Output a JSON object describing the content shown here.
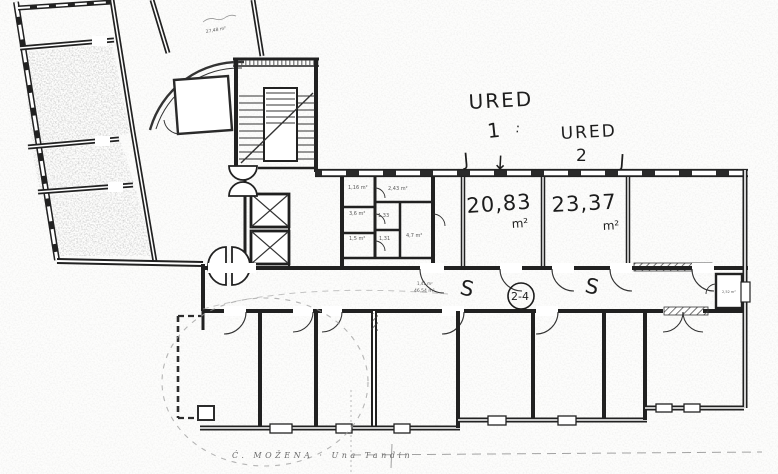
{
  "document": {
    "kind": "scanned floor plan",
    "caption": "Ć. MOŽENA · Una Tandin",
    "colors": {
      "ink": "#1f1f1f",
      "faint": "#8a8a8a",
      "paper": "#fdfdfc"
    }
  },
  "rooms": [
    {
      "name": "URED 1",
      "area": "20,83 m²"
    },
    {
      "name": "URED 2",
      "area": "23,37 m²"
    }
  ],
  "annotations": {
    "handwritten": [
      {
        "id": "ured1-word",
        "text": "URED",
        "x": 469,
        "y": 109,
        "size": 20,
        "rot": -3,
        "ls": 2
      },
      {
        "id": "ured1-number",
        "text": "1",
        "x": 488,
        "y": 138,
        "size": 20,
        "rot": -6
      },
      {
        "id": "ured1-colon",
        "text": ":",
        "x": 515,
        "y": 132,
        "size": 13,
        "rot": 8
      },
      {
        "id": "ured2-word",
        "text": "URED",
        "x": 561,
        "y": 139,
        "size": 17,
        "rot": -3,
        "ls": 2
      },
      {
        "id": "ured2-number",
        "text": "2",
        "x": 576,
        "y": 161,
        "size": 17,
        "rot": 0
      },
      {
        "id": "j-mark-left",
        "text": "J",
        "x": 464,
        "y": 166,
        "size": 18,
        "rot": -5
      },
      {
        "id": "down-arrow",
        "text": "↓",
        "x": 492,
        "y": 169,
        "size": 19,
        "rot": 3
      },
      {
        "id": "j-mark-right",
        "text": "J",
        "x": 619,
        "y": 167,
        "size": 18,
        "rot": 4
      },
      {
        "id": "area-ured1",
        "text": "20,83",
        "x": 467,
        "y": 213,
        "size": 21,
        "rot": -4,
        "ls": 1
      },
      {
        "id": "area-ured1-unit",
        "text": "m²",
        "x": 512,
        "y": 228,
        "size": 12,
        "rot": -4
      },
      {
        "id": "area-ured2",
        "text": "23,37",
        "x": 552,
        "y": 212,
        "size": 21,
        "rot": -3,
        "ls": 1
      },
      {
        "id": "area-ured2-unit",
        "text": "m²",
        "x": 603,
        "y": 230,
        "size": 12,
        "rot": -3
      },
      {
        "id": "s-mark-left",
        "text": "S",
        "x": 459,
        "y": 294,
        "size": 21,
        "rot": 12
      },
      {
        "id": "s-mark-right",
        "text": "S",
        "x": 584,
        "y": 292,
        "size": 21,
        "rot": 12
      },
      {
        "id": "room-number-circled",
        "text": "2-4",
        "x": 511,
        "y": 300,
        "size": 11,
        "rot": 0,
        "circle": {
          "cx": 521,
          "cy": 296,
          "r": 13
        }
      }
    ],
    "printed_small": [
      {
        "id": "area-wc-1",
        "text": "1,16 m²",
        "x": 348,
        "y": 189,
        "size": 5
      },
      {
        "id": "area-anteroom",
        "text": "2,43 m²",
        "x": 388,
        "y": 190,
        "size": 5
      },
      {
        "id": "area-wc-2",
        "text": "3,6 m²",
        "x": 349,
        "y": 215,
        "size": 5
      },
      {
        "id": "area-wc-3",
        "text": "1,33",
        "x": 378,
        "y": 217,
        "size": 5
      },
      {
        "id": "area-wc-4",
        "text": "1,5 m²",
        "x": 349,
        "y": 240,
        "size": 5
      },
      {
        "id": "area-wc-5",
        "text": "1,31",
        "x": 379,
        "y": 240,
        "size": 5
      },
      {
        "id": "area-lobby",
        "text": "4,7 m²",
        "x": 406,
        "y": 237,
        "size": 5
      },
      {
        "id": "area-corridor-line1",
        "text": "1,41 m²",
        "x": 417,
        "y": 285,
        "size": 4
      },
      {
        "id": "area-corridor-line2",
        "text": "46,54 m²",
        "x": 414,
        "y": 292,
        "size": 4.5
      },
      {
        "id": "area-top-note",
        "text": "27,48 m²",
        "x": 206,
        "y": 33,
        "size": 4.5,
        "rot": -10
      },
      {
        "id": "area-wc-right",
        "text": "2,52 m²",
        "x": 722,
        "y": 293,
        "size": 3.5
      }
    ]
  }
}
